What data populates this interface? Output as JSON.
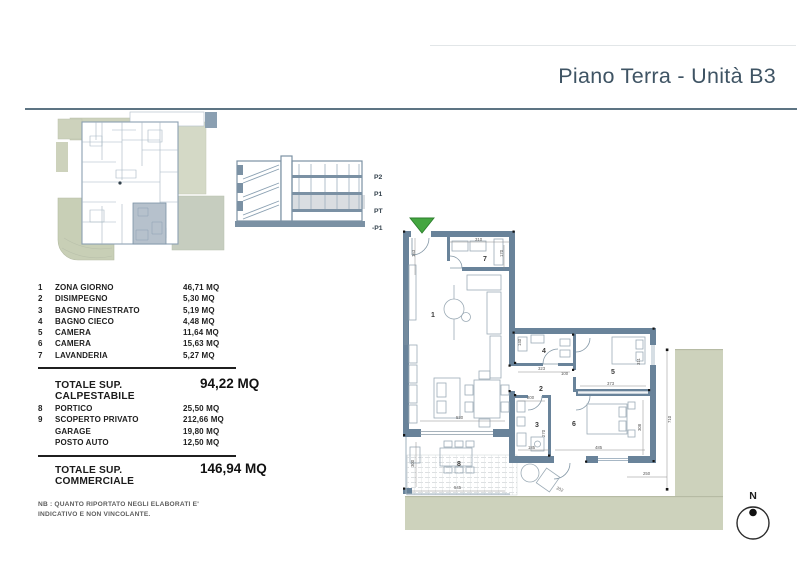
{
  "title": "Piano Terra - Unità B3",
  "section_levels": [
    "P2",
    "P1",
    "PT",
    "-P1"
  ],
  "area_table": {
    "rows": [
      {
        "num": "1",
        "label": "ZONA GIORNO",
        "value": "46,71 MQ"
      },
      {
        "num": "2",
        "label": "DISIMPEGNO",
        "value": "5,30 MQ"
      },
      {
        "num": "3",
        "label": "BAGNO FINESTRATO",
        "value": "5,19 MQ"
      },
      {
        "num": "4",
        "label": "BAGNO CIECO",
        "value": "4,48 MQ"
      },
      {
        "num": "5",
        "label": "CAMERA",
        "value": "11,64 MQ"
      },
      {
        "num": "6",
        "label": "CAMERA",
        "value": "15,63 MQ"
      },
      {
        "num": "7",
        "label": "LAVANDERIA",
        "value": "5,27 MQ"
      }
    ],
    "total_calpestabile": {
      "label": "TOTALE SUP. CALPESTABILE",
      "value": "94,22 MQ"
    },
    "extra_rows": [
      {
        "num": "8",
        "label": "PORTICO",
        "value": "25,50 MQ"
      },
      {
        "num": "9",
        "label": "SCOPERTO PRIVATO",
        "value": "212,66 MQ"
      },
      {
        "num": "",
        "label": "GARAGE",
        "value": "19,80 MQ"
      },
      {
        "num": "",
        "label": "POSTO AUTO",
        "value": "12,50 MQ"
      }
    ],
    "total_commerciale": {
      "label": "TOTALE SUP. COMMERCIALE",
      "value": "146,94 MQ"
    }
  },
  "note": "NB : QUANTO RIPORTATO NEGLI ELABORATI E' INDICATIVO E NON VINCOLANTE.",
  "plan": {
    "room_labels": [
      "1",
      "7",
      "4",
      "5",
      "2",
      "3",
      "6",
      "8"
    ],
    "dims": [
      "163",
      "310",
      "170",
      "140",
      "323",
      "100",
      "200",
      "373",
      "311",
      "710",
      "308",
      "270",
      "185",
      "485",
      "530",
      "300",
      "545",
      "250",
      "202"
    ]
  },
  "north_label": "N",
  "colors": {
    "wall": "#69839a",
    "section_line": "#7b91a4",
    "green_area": "#cdd2bc",
    "highlight_unit": "#b6c1cc",
    "entrance_triangle": "#44a640",
    "title_text": "#3f5464"
  }
}
